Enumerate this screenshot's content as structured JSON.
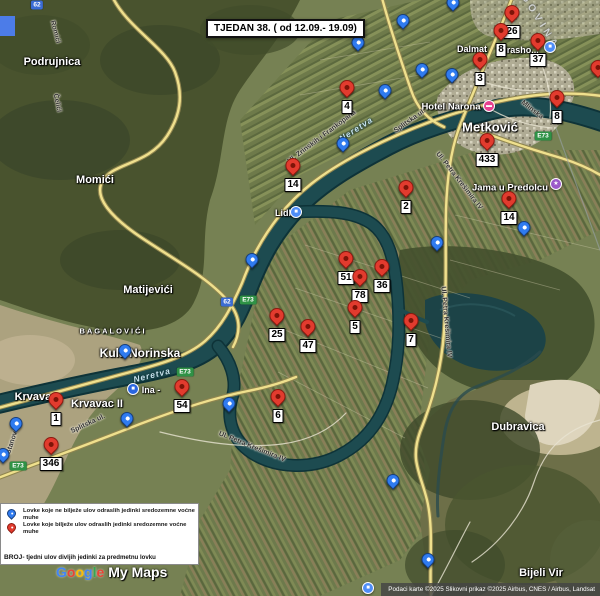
{
  "map": {
    "title": "TJEDAN 38. ( od 12.09.- 19.09)"
  },
  "colors": {
    "red_pin": "#e23b2e",
    "red_pin_center": "#7d1408",
    "blue_pin": "#2f7bf0",
    "blue_pin_center": "#ffffff"
  },
  "pins": [
    {
      "x": 347,
      "y": 88,
      "c": "red",
      "label": "4"
    },
    {
      "x": 512,
      "y": 13,
      "c": "red",
      "label": "26"
    },
    {
      "x": 501,
      "y": 31,
      "c": "red",
      "label": "8"
    },
    {
      "x": 538,
      "y": 41,
      "c": "red",
      "label": "37"
    },
    {
      "x": 480,
      "y": 60,
      "c": "red",
      "label": "3"
    },
    {
      "x": 557,
      "y": 98,
      "c": "red",
      "label": "8"
    },
    {
      "x": 487,
      "y": 141,
      "c": "red",
      "label": "433"
    },
    {
      "x": 293,
      "y": 166,
      "c": "red",
      "label": "14"
    },
    {
      "x": 406,
      "y": 188,
      "c": "red",
      "label": "2"
    },
    {
      "x": 509,
      "y": 199,
      "c": "red",
      "label": "14"
    },
    {
      "x": 346,
      "y": 259,
      "c": "red",
      "label": "51"
    },
    {
      "x": 382,
      "y": 267,
      "c": "red",
      "label": "36"
    },
    {
      "x": 360,
      "y": 277,
      "c": "red",
      "label": "78"
    },
    {
      "x": 355,
      "y": 308,
      "c": "red",
      "label": "5"
    },
    {
      "x": 308,
      "y": 327,
      "c": "red",
      "label": "47"
    },
    {
      "x": 411,
      "y": 321,
      "c": "red",
      "label": "7"
    },
    {
      "x": 277,
      "y": 316,
      "c": "red",
      "label": "25"
    },
    {
      "x": 182,
      "y": 387,
      "c": "red",
      "label": "54"
    },
    {
      "x": 278,
      "y": 397,
      "c": "red",
      "label": "6"
    },
    {
      "x": 56,
      "y": 400,
      "c": "red",
      "label": "1"
    },
    {
      "x": 51,
      "y": 445,
      "c": "red",
      "label": "346"
    },
    {
      "x": 598,
      "y": 68,
      "c": "red",
      "label": null
    },
    {
      "x": 453,
      "y": 4,
      "c": "blue",
      "label": null
    },
    {
      "x": 403,
      "y": 22,
      "c": "blue",
      "label": null
    },
    {
      "x": 358,
      "y": 44,
      "c": "blue",
      "label": null
    },
    {
      "x": 422,
      "y": 71,
      "c": "blue",
      "label": null
    },
    {
      "x": 452,
      "y": 76,
      "c": "blue",
      "label": null
    },
    {
      "x": 385,
      "y": 92,
      "c": "blue",
      "label": null
    },
    {
      "x": 343,
      "y": 145,
      "c": "blue",
      "label": null
    },
    {
      "x": 252,
      "y": 261,
      "c": "blue",
      "label": null
    },
    {
      "x": 437,
      "y": 244,
      "c": "blue",
      "label": null
    },
    {
      "x": 524,
      "y": 229,
      "c": "blue",
      "label": null
    },
    {
      "x": 125,
      "y": 352,
      "c": "blue",
      "label": null
    },
    {
      "x": 16,
      "y": 425,
      "c": "blue",
      "label": null
    },
    {
      "x": 3,
      "y": 456,
      "c": "blue",
      "label": null
    },
    {
      "x": 127,
      "y": 420,
      "c": "blue",
      "label": null
    },
    {
      "x": 229,
      "y": 405,
      "c": "blue",
      "label": null
    },
    {
      "x": 393,
      "y": 482,
      "c": "blue",
      "label": null
    },
    {
      "x": 428,
      "y": 561,
      "c": "blue",
      "label": null
    }
  ],
  "labels": {
    "places": [
      {
        "text": "Podrujnica",
        "x": 52,
        "y": 62,
        "s": 11
      },
      {
        "text": "Momići",
        "x": 95,
        "y": 180,
        "s": 11
      },
      {
        "text": "Matijevići",
        "x": 148,
        "y": 290,
        "s": 11
      },
      {
        "text": "BAGALOVIĆI",
        "x": 113,
        "y": 331,
        "s": 7.5,
        "sp": 2
      },
      {
        "text": "Kula Norinska",
        "x": 140,
        "y": 353,
        "s": 12
      },
      {
        "text": "Krvavac",
        "x": 36,
        "y": 397,
        "s": 11
      },
      {
        "text": "Krvavac II",
        "x": 97,
        "y": 404,
        "s": 11
      },
      {
        "text": "Metković",
        "x": 490,
        "y": 127,
        "s": 13
      },
      {
        "text": "Dubravica",
        "x": 518,
        "y": 427,
        "s": 11
      },
      {
        "text": "Bijeli Vir",
        "x": 541,
        "y": 573,
        "s": 11
      },
      {
        "text": "Hotel Narona",
        "x": 451,
        "y": 107,
        "s": 9.5
      },
      {
        "text": "Jama u Predolcu",
        "x": 510,
        "y": 188,
        "s": 9.5
      },
      {
        "text": "Dalmat",
        "x": 472,
        "y": 49,
        "s": 9
      },
      {
        "text": "urasho...",
        "x": 520,
        "y": 50,
        "s": 9
      },
      {
        "text": "Lidl",
        "x": 283,
        "y": 213,
        "s": 9
      },
      {
        "text": "Ina -",
        "x": 151,
        "y": 390,
        "s": 9
      }
    ],
    "roads": [
      {
        "text": "Romići",
        "x": 55,
        "y": 32,
        "rot": 75
      },
      {
        "text": "Čelići",
        "x": 57,
        "y": 103,
        "rot": 78
      },
      {
        "text": "Ul. Zrinskih i Frankopana",
        "x": 322,
        "y": 137,
        "rot": -37
      },
      {
        "text": "Splitska ul.",
        "x": 410,
        "y": 121,
        "rot": -35
      },
      {
        "text": "Splitska ul.",
        "x": 88,
        "y": 424,
        "rot": -25
      },
      {
        "text": "Ul. Petra Krešimira IV",
        "x": 459,
        "y": 181,
        "rot": 52
      },
      {
        "text": "Ul. Petra Krešimira IV",
        "x": 446,
        "y": 322,
        "rot": 85
      },
      {
        "text": "Ul. Petra Krešimira IV",
        "x": 252,
        "y": 447,
        "rot": 22
      },
      {
        "text": "Mlinska",
        "x": 532,
        "y": 110,
        "rot": 38
      },
      {
        "text": "Stanovci",
        "x": 13,
        "y": 440,
        "rot": -72
      }
    ],
    "rivers": [
      {
        "text": "Neretva",
        "x": 356,
        "y": 129,
        "rot": -33
      },
      {
        "text": "Neretva",
        "x": 152,
        "y": 375,
        "rot": -14
      }
    ],
    "border": [
      {
        "text": "GOVINA",
        "x": 540,
        "y": 22,
        "rot": 58
      }
    ]
  },
  "shields": [
    {
      "t": "62",
      "k": "blue",
      "x": 37,
      "y": 5
    },
    {
      "t": "62",
      "k": "blue",
      "x": 227,
      "y": 302
    },
    {
      "t": "E73",
      "k": "green",
      "x": 248,
      "y": 300
    },
    {
      "t": "E73",
      "k": "green",
      "x": 185,
      "y": 372
    },
    {
      "t": "E73",
      "k": "green",
      "x": 543,
      "y": 136
    },
    {
      "t": "E73",
      "k": "green",
      "x": 18,
      "y": 466
    }
  ],
  "pois": [
    {
      "name": "hotel-narona-icon",
      "x": 489,
      "y": 106,
      "color": "#e7418f",
      "glyph": "▬"
    },
    {
      "name": "jama-u-predolcu-icon",
      "x": 556,
      "y": 184,
      "color": "#9b59c9",
      "glyph": "★"
    },
    {
      "name": "shop-poi-icon",
      "x": 550,
      "y": 47,
      "color": "#4e8df7",
      "glyph": "■"
    },
    {
      "name": "lidl-poi-icon",
      "x": 296,
      "y": 212,
      "color": "#4e8df7",
      "glyph": "■"
    },
    {
      "name": "ina-gas-icon",
      "x": 133,
      "y": 389,
      "color": "#2a66e0",
      "glyph": "■"
    },
    {
      "name": "bottom-poi-icon",
      "x": 368,
      "y": 588,
      "color": "#4e8df7",
      "glyph": "■"
    }
  ],
  "legend": {
    "items": [
      {
        "color": "blue",
        "text": "Lovke koje ne bilježe ulov odraslih jedinki sredozemne voćne muhe"
      },
      {
        "color": "red",
        "text": "Lovke koje bilježe ulov odraslih jedinki sredozemne voćne muhe"
      }
    ],
    "note_prefix": "BROJ-",
    "note_text": " tjedni ulov divljih jedinki za predmetnu lovku"
  },
  "logo": {
    "letters": [
      {
        "ch": "G",
        "color": "#4285F4"
      },
      {
        "ch": "o",
        "color": "#EA4335"
      },
      {
        "ch": "o",
        "color": "#FBBC05"
      },
      {
        "ch": "g",
        "color": "#4285F4"
      },
      {
        "ch": "l",
        "color": "#34A853"
      },
      {
        "ch": "e",
        "color": "#EA4335"
      }
    ],
    "suffix": "My Maps"
  },
  "attribution": "Podaci karte ©2025 Slikovni prikaz ©2025 Airbus, CNES / Airbus, Landsat"
}
